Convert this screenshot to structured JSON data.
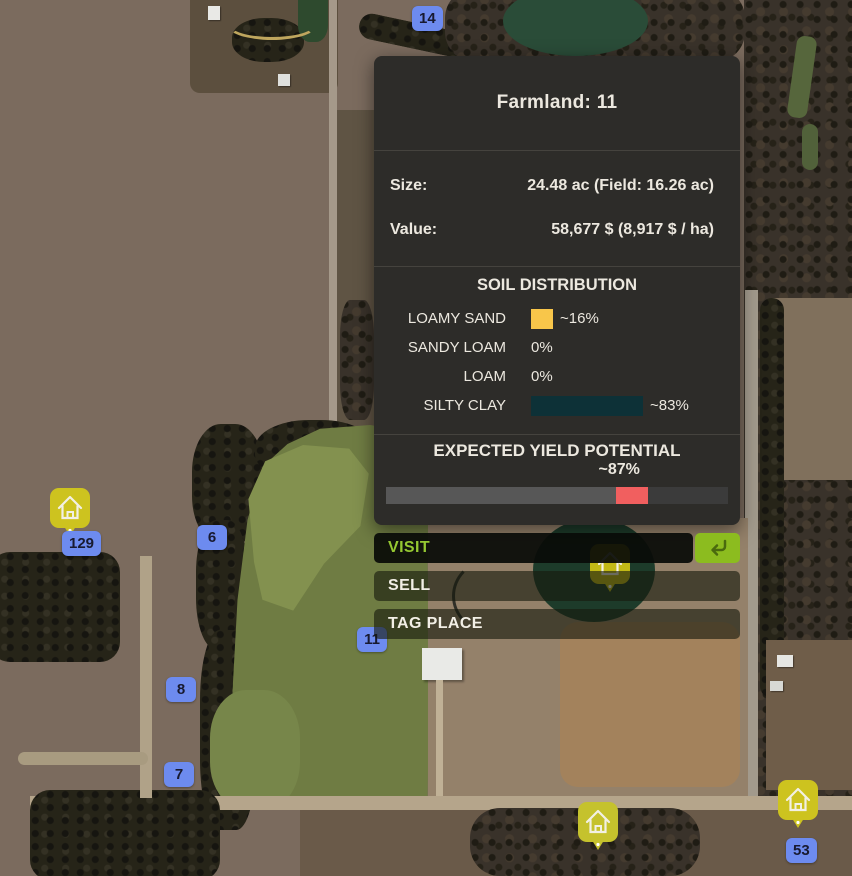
{
  "panel": {
    "title": "Farmland: 11",
    "stats": [
      {
        "label": "Size:",
        "value": "24.48 ac (Field: 16.26 ac)"
      },
      {
        "label": "Value:",
        "value": "58,677 $ (8,917 $ / ha)"
      }
    ],
    "soil": {
      "heading": "SOIL DISTRIBUTION",
      "rows": [
        {
          "label": "LOAMY SAND",
          "display": "~16%",
          "percent": 16,
          "color": "#f8c64a"
        },
        {
          "label": "SANDY LOAM",
          "display": "0%",
          "percent": 0,
          "color": null
        },
        {
          "label": "LOAM",
          "display": "0%",
          "percent": 0,
          "color": null
        },
        {
          "label": "SILTY CLAY",
          "display": "~83%",
          "percent": 83,
          "color": "#0d3137"
        }
      ]
    },
    "yield": {
      "heading": "EXPECTED YIELD POTENTIAL",
      "display": "~87%",
      "percent": 87,
      "marker_center_pct": 72,
      "marker_width_pct": 9.5
    }
  },
  "actions": {
    "visit": "VISIT",
    "sell": "SELL",
    "tag_place": "TAG PLACE"
  },
  "icons": {
    "visit_shortcut": "return-arrow-icon",
    "farm_pin": "house-icon"
  },
  "markers": [
    {
      "label": "14"
    },
    {
      "label": "6"
    },
    {
      "label": "129"
    },
    {
      "label": "11"
    },
    {
      "label": "8"
    },
    {
      "label": "7"
    },
    {
      "label": "53"
    }
  ],
  "colors": {
    "accent_green": "#95c832",
    "shortcut_button_green": "#8cbc1f",
    "marker_blue": "#6d8bef",
    "pin_yellow": "#cdc31f",
    "panel_bg": "#2d2c29",
    "soil_loamy_sand": "#f8c64a",
    "soil_silty_clay": "#0d3137",
    "yield_marker_red": "#f15f5f"
  }
}
